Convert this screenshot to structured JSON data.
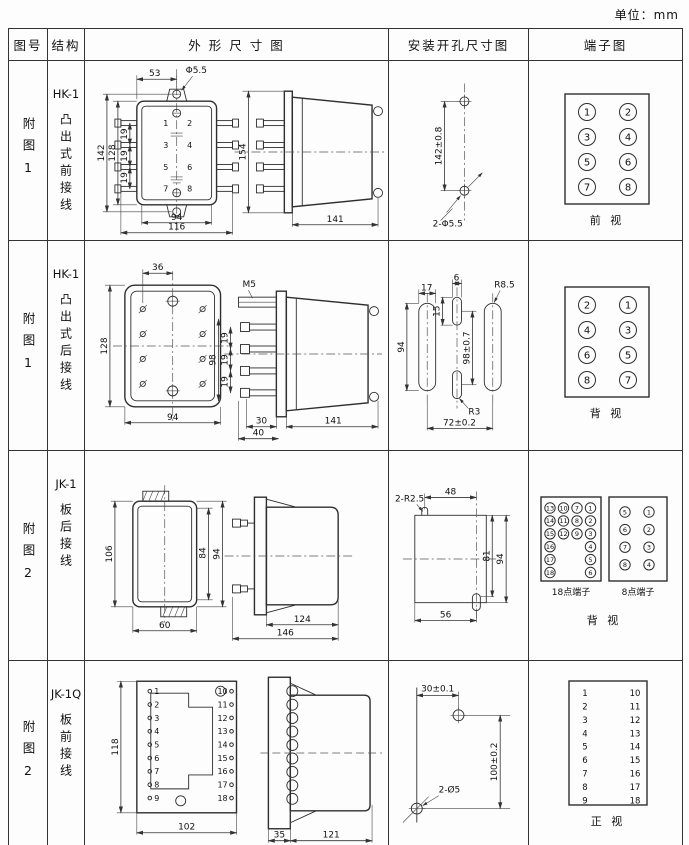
{
  "unit_label": "单位：mm",
  "header": {
    "fig": "图号",
    "structure": "结构",
    "outline": "外 形 尺 寸 图",
    "mounting": "安装开孔尺寸图",
    "terminal": "端子图"
  },
  "rows": [
    {
      "fig": "附图1",
      "model": "HK-1",
      "structure": "凸出式前接线",
      "outline": {
        "top_w": "53",
        "hole": "Φ5.5",
        "h_outer": "142",
        "h_body": "128",
        "pitch1": "19",
        "pitch2": "19",
        "pitch3": "19",
        "w_inner": "94",
        "w_outer": "116",
        "side_h": "154",
        "depth": "141"
      },
      "mounting": {
        "v": "142±0.8",
        "label": "2-Φ5.5"
      },
      "terminal": {
        "grid": [
          [
            "1",
            "3",
            "5",
            "7"
          ],
          [
            "2",
            "4",
            "6",
            "8"
          ]
        ],
        "caption": "前  视"
      }
    },
    {
      "fig": "附图1",
      "model": "HK-1",
      "structure": "凸出式后接线",
      "outline": {
        "top_w": "36",
        "h_body": "128",
        "w_body": "94",
        "stud": "M5",
        "h_span": "98",
        "pitch1": "19",
        "pitch2": "19",
        "pitch3": "19",
        "b1": "30",
        "b2": "40",
        "depth": "141"
      },
      "mounting": {
        "slot_w": "17",
        "slot_h": "94",
        "mid_w": "6",
        "mid_off": "15",
        "v": "98±0.7",
        "r_big": "R8.5",
        "r_small": "R3",
        "span": "72±0.2"
      },
      "terminal": {
        "grid": [
          [
            "2",
            "4",
            "6",
            "8"
          ],
          [
            "1",
            "3",
            "5",
            "7"
          ]
        ],
        "caption": "背  视"
      }
    },
    {
      "fig": "附图2",
      "model": "JK-1",
      "structure": "板后接线",
      "outline": {
        "h": "106",
        "h_in": "84",
        "h_out": "94",
        "w": "60",
        "body": "124",
        "total": "146"
      },
      "mounting": {
        "notch": "2-R2.5",
        "top": "48",
        "v_in": "81",
        "v_out": "94",
        "bottom": "56"
      },
      "terminal": {
        "grid18": [
          [
            "13",
            "14",
            "15",
            "16",
            "17",
            "18"
          ],
          [
            "10",
            "11",
            "12"
          ],
          [
            "7",
            "8",
            "9"
          ],
          [
            "1",
            "2",
            "3",
            "4",
            "5",
            "6"
          ]
        ],
        "grid8": [
          [
            "5",
            "6",
            "7",
            "8"
          ],
          [
            "1",
            "2",
            "3",
            "4"
          ]
        ],
        "cap18": "18点端子",
        "cap8": "8点端子",
        "caption": "背  视"
      }
    },
    {
      "fig": "附图2",
      "model": "JK-1Q",
      "structure": "板前接线",
      "outline": {
        "h": "118",
        "w": "102",
        "flange": "35",
        "body": "121",
        "left": [
          "1",
          "2",
          "3",
          "4",
          "5",
          "6",
          "7",
          "8",
          "9"
        ],
        "right": [
          "10",
          "11",
          "12",
          "13",
          "14",
          "15",
          "16",
          "17",
          "18"
        ]
      },
      "mounting": {
        "top": "30±0.1",
        "v": "100±0.2",
        "label": "2-Ø5"
      },
      "terminal": {
        "grid": [
          [
            "1",
            "2",
            "3",
            "4",
            "5",
            "6",
            "7",
            "8",
            "9"
          ],
          [
            "10",
            "11",
            "12",
            "13",
            "14",
            "15",
            "16",
            "17",
            "18"
          ]
        ],
        "caption": "正  视"
      }
    }
  ]
}
